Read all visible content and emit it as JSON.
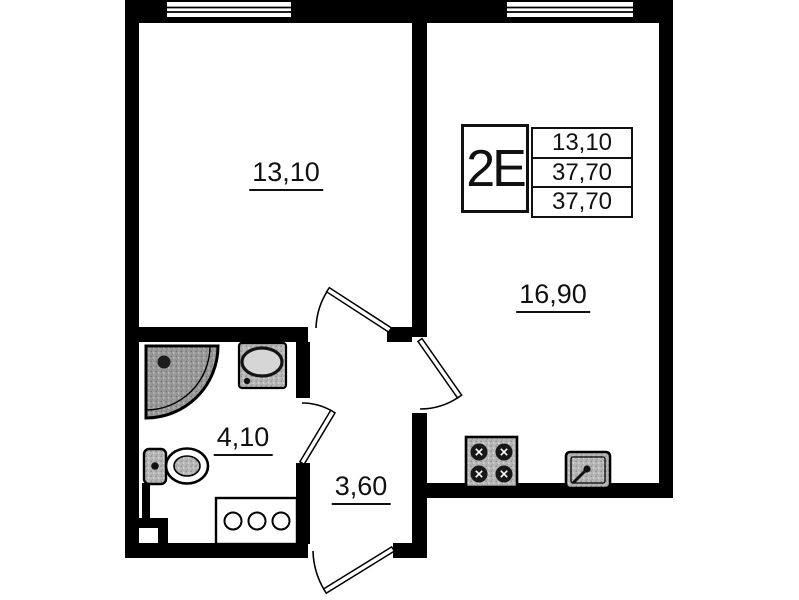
{
  "legend": {
    "type": "2Е",
    "values": [
      "13,10",
      "37,70",
      "37,70"
    ]
  },
  "rooms": {
    "living": {
      "area": "13,10"
    },
    "kitchen_living": {
      "area": "16,90"
    },
    "bathroom": {
      "area": "4,10"
    },
    "hallway": {
      "area": "3,60"
    }
  },
  "colors": {
    "wall": "#000000",
    "background": "#ffffff",
    "fixture_fill": "#b7b7b7",
    "shower_fill": "#9a9a9a",
    "text": "#111111"
  },
  "icons": {
    "window": "window-icon",
    "door": "door-swing-icon",
    "shower": "shower-tray-icon",
    "washbasin": "washbasin-icon",
    "toilet": "toilet-icon",
    "cabinet": "cabinet-three-knobs-icon",
    "stove": "stove-four-burner-icon",
    "kitchen_sink": "kitchen-sink-icon"
  }
}
